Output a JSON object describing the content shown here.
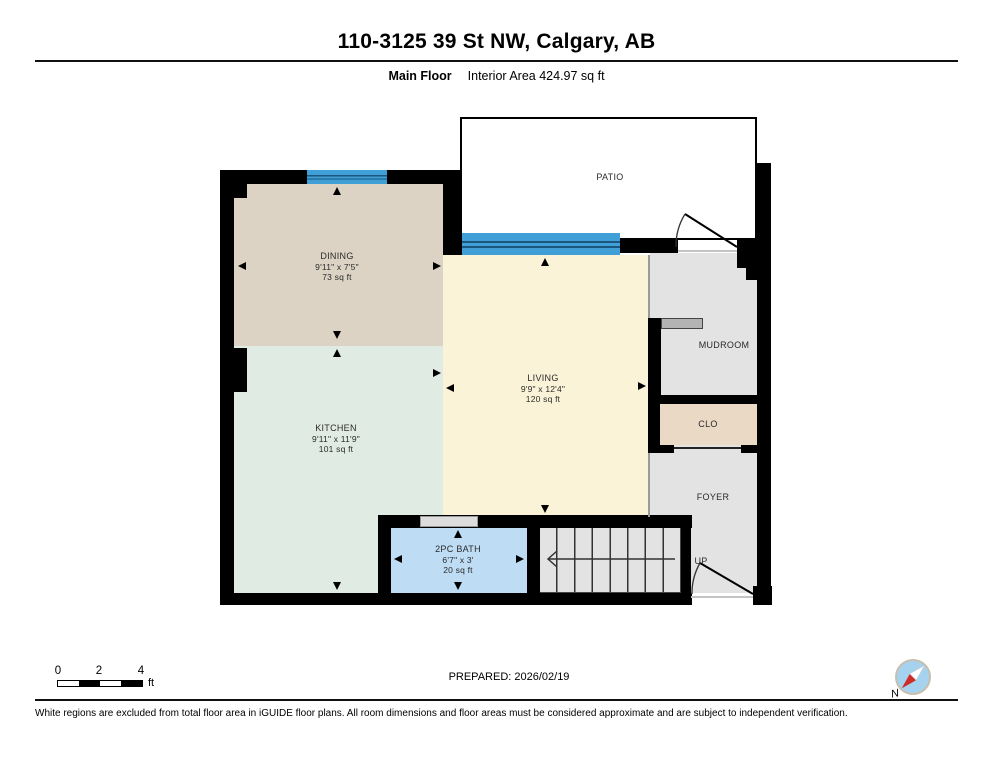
{
  "header": {
    "title": "110-3125 39 St NW, Calgary, AB",
    "floor_label": "Main Floor",
    "area_label": "Interior Area 424.97 sq ft"
  },
  "rooms": {
    "patio": {
      "name": "PATIO"
    },
    "dining": {
      "name": "DINING",
      "dims": "9'11\" x 7'5\"",
      "area": "73 sq ft"
    },
    "kitchen": {
      "name": "KITCHEN",
      "dims": "9'11\" x 11'9\"",
      "area": "101 sq ft"
    },
    "living": {
      "name": "LIVING",
      "dims": "9'9\" x 12'4\"",
      "area": "120 sq ft"
    },
    "bath": {
      "name": "2PC BATH",
      "dims": "6'7\" x 3'",
      "area": "20 sq ft"
    },
    "mudroom": {
      "name": "MUDROOM"
    },
    "closet": {
      "name": "CLO"
    },
    "foyer": {
      "name": "FOYER"
    }
  },
  "stairs": {
    "direction_label": "UP"
  },
  "scale_bar": {
    "start": "0",
    "mid": "2",
    "end": "4",
    "unit": "ft"
  },
  "compass": {
    "label": "N"
  },
  "footer": {
    "prepared": "PREPARED: 2026/02/19",
    "disclaimer": "White regions are excluded from total floor area in iGUIDE floor plans. All room dimensions and floor areas must be considered approximate and are subject to independent verification."
  },
  "colors": {
    "wall": "#000000",
    "dining_fill": "#dcd3c4",
    "kitchen_fill": "#e0ebe4",
    "living_fill": "#faf3d8",
    "bath_fill": "#bedcf4",
    "gray_fill": "#e3e3e3",
    "closet_fill": "#ead9c5",
    "window_blue": "#3f9fd6",
    "compass_blue": "#a5d2ef",
    "compass_red": "#cf2b27"
  }
}
